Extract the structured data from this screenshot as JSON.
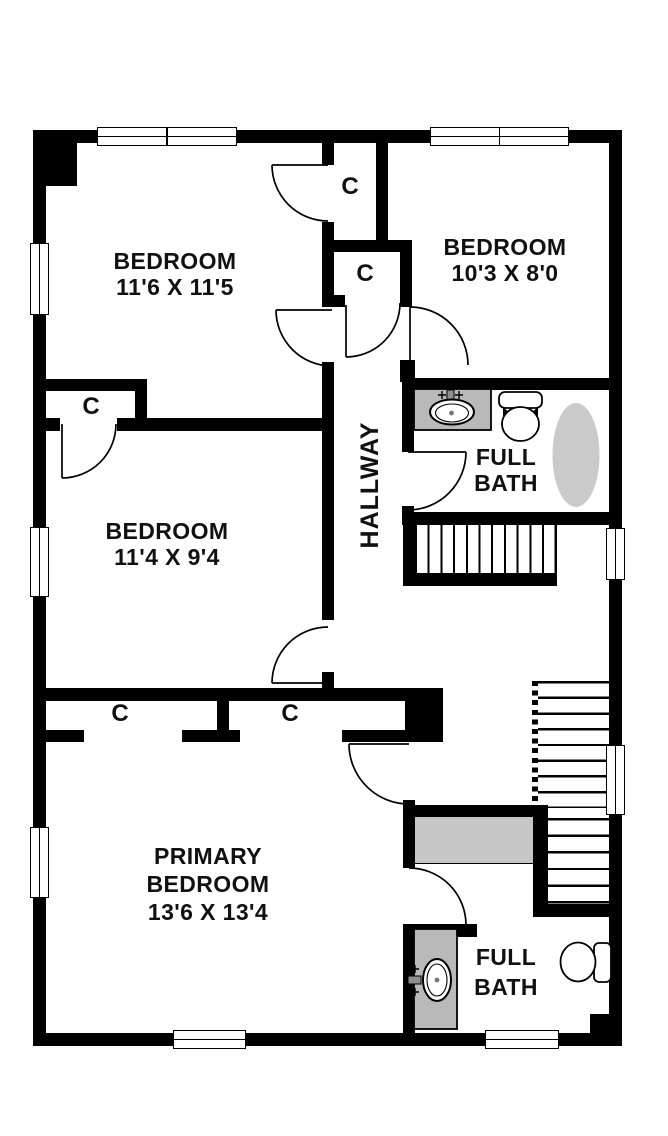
{
  "rooms": {
    "bedroom_top_left": {
      "name": "BEDROOM",
      "dims": "11'6 X 11'5"
    },
    "bedroom_top_right": {
      "name": "BEDROOM",
      "dims": "10'3 X 8'0"
    },
    "bedroom_mid_left": {
      "name": "BEDROOM",
      "dims": "11'4 X 9'4"
    },
    "primary_bedroom": {
      "line1": "PRIMARY",
      "line2": "BEDROOM",
      "dims": "13'6 X 13'4"
    },
    "hallway": {
      "name": "HALLWAY"
    },
    "bath_upper": {
      "line1": "FULL",
      "line2": "BATH"
    },
    "bath_lower": {
      "line1": "FULL",
      "line2": "BATH"
    }
  },
  "closet_label": "C",
  "colors": {
    "wall": "#000000",
    "floor": "#ffffff",
    "vanity_gray": "#b9b9b9",
    "tub_gray": "#cacaca",
    "counter_gray": "#c6c6c6"
  },
  "fixtures": {
    "bath_upper": [
      "vanity-sink",
      "toilet",
      "bathtub"
    ],
    "bath_lower": [
      "vanity-sink",
      "toilet"
    ],
    "stairs": "staircase"
  }
}
